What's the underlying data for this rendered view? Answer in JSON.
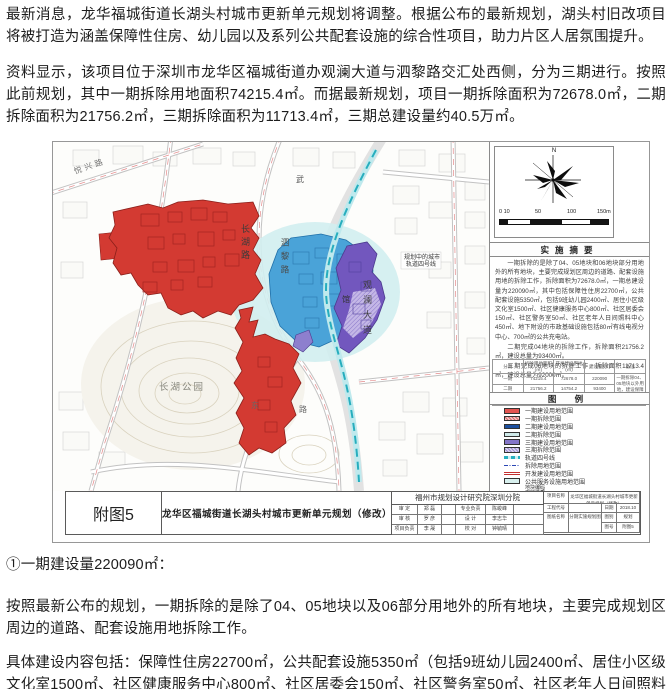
{
  "article": {
    "para1": "最新消息，龙华福城街道长湖头村城市更新单元规划将调整。根据公布的最新规划，湖头村旧改项目将被打造为涵盖保障性住房、幼儿园以及系列公共配套设施的综合性项目，助力片区人居氛围提升。",
    "para2": "资料显示，该项目位于深圳市龙华区福城街道办观澜大道与泗黎路交汇处西侧，分为三期进行。按照此前规划，其中一期拆除用地面积74215.4㎡。而据最新规划，项目一期拆除面积为72678.0㎡，二期拆除面积为21756.2㎡，三期拆除面积为11713.4㎡，三期总建设量约40.5万㎡。",
    "section_heading": "①一期建设量220090㎡：",
    "para3": "按照最新公布的规划，一期拆除的是除了04、05地块以及06部分用地外的所有地块，主要完成规划区周边的道路、配套设施用地拆除工作。",
    "para4": "具体建设内容包括：保障性住房22700㎡，公共配套设施5350㎡（包括9班幼儿园2400㎡、居住小区级文化室1500㎡、社区健康服务中心800㎡、社区居委会150㎡、社区警务室50㎡、社区老年人日间照料中心"
  },
  "figure": {
    "map": {
      "labels": {
        "yuexing": "悦兴路",
        "changhu_rd": "长湖路",
        "sili": "泗黎路",
        "guanlan": "观澜大道",
        "wu": "武",
        "guanz": "馆",
        "dong": "东",
        "lu": "路",
        "park": "长湖公园",
        "rail_l1": "规划中的城市",
        "rail_l2": "轨道四号线"
      }
    },
    "compass": {
      "north": "N"
    },
    "scale": {
      "t0": "0 10",
      "t1": "50",
      "t2": "100",
      "t3": "150m"
    },
    "summary": {
      "title": "实施摘要",
      "p1": "一期拆除的是除了04、05地块和06地块部分用地外的所有地块，主要完成规划区周边的道路、配套设施用地的拆除工作，拆除面积为72678.0㎡，一期总建设量为220090㎡，其中包括保障性住房22700㎡，公共配套设施5350㎡，包括9班幼儿园2400㎡、居住小区级文化室1500㎡、社区健康服务中心800㎡、社区居委会150㎡、社区警务室50㎡、社区老年人日间照料中心450㎡、地下附设的市政基础设施包括80㎡有线电视分中心、700㎡的公共充电站。",
      "p2": "二期完成04地块的拆除工作，拆除面积21756.2㎡，建设总量为93400㎡。",
      "p3": "三期完成06地块的拆除工作，拆除面积11713.4㎡，建设总量为92000㎡。"
    },
    "zone_table": {
      "h0": "分期",
      "h1": "拆除用地面积(㎡)",
      "h2": "开发建设用地(㎡)",
      "h3": "建设量(㎡)",
      "h4": "备注",
      "r0c0": "一期",
      "r0c1": "74215.4",
      "r0c2": "72678.0",
      "r0c3": "220090",
      "r0c4": "一期拆除04、05地块以外用地，建设保障性住房及公共配套设施",
      "r1c0": "二期",
      "r1c1": "21756.2",
      "r1c2": "14754.2",
      "r1c3": "93400",
      "r1c4": "",
      "r2c0": "三期",
      "r2c1": "11713.4",
      "r2c2": "9545.3",
      "r2c3": "92000",
      "r2c4": ""
    },
    "legend": {
      "title": "图 例",
      "items": [
        {
          "label": "一期建设用地范围"
        },
        {
          "label": "一期拆除范围"
        },
        {
          "label": "二期建设用地范围"
        },
        {
          "label": "二期拆除范围"
        },
        {
          "label": "三期建设用地范围"
        },
        {
          "label": "三期拆除范围"
        },
        {
          "label": "轨道四号线"
        },
        {
          "label": "拆除用地范围"
        },
        {
          "label": "开发建设用地范围"
        },
        {
          "label": "公共服务设施用地范围"
        },
        {
          "label": "地块编码",
          "label2": "用地性质"
        }
      ]
    },
    "titlebar": {
      "fig_no": "附图5",
      "title": "龙华区福城街道长湖头村城市更新单元规划（修改）",
      "institute": "福州市规划设计研究院深圳分院",
      "credits": {
        "r1l": "审 定",
        "r1v": "郑 磊",
        "r1m": "专业负责",
        "r1mv": "陈峻峰",
        "r2l": "审 核",
        "r2v": "罗 彦",
        "r2m": "设 计",
        "r2mv": "李志华",
        "r3l": "项目负责",
        "r3v": "李 晟",
        "r3m": "校 对",
        "r3mv": "钟毓晴"
      },
      "project_label": "项目名称",
      "project_name": "龙华区福城街道长湖头村城市更新单元规划（修改）",
      "code_label": "工程代号",
      "date_label": "日期",
      "date_value": "2018.10",
      "sheet_label": "图纸名称",
      "sheet_name": "分期实施规划图",
      "type_label": "图别",
      "type_value": "规划",
      "no_label": "图号",
      "no_value": "附图5"
    }
  }
}
